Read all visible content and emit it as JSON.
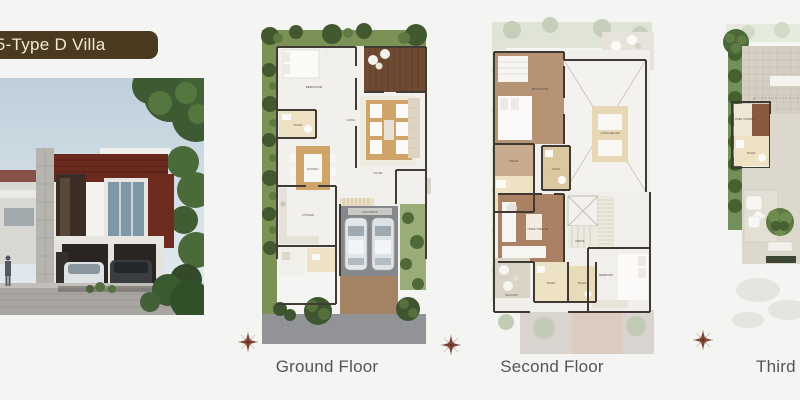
{
  "banner": {
    "label": "75-Type D Villa"
  },
  "floors": [
    {
      "label": "Ground Floor",
      "rooms": {
        "bedroom": "BEDROOM",
        "toilet": "TOILET",
        "dining": "DINING",
        "living": "LIVING",
        "kitchen": "KITCHEN",
        "foyer": "FOYER",
        "car_porch": "CAR PORCH",
        "deck": "DECK"
      }
    },
    {
      "label": "Second Floor",
      "rooms": {
        "bedroom1": "BEDROOM",
        "deck": "DECK",
        "living_below": "LIVING BELOW",
        "dress1": "DRESS",
        "toilet1": "TOILET",
        "toilet2": "TOILET",
        "home_theatre": "HOME THEATRE",
        "dress2": "DRESS",
        "bedroom2": "BEDROOM",
        "toilet3": "TOILET",
        "toilet4": "TOILET",
        "balcony": "BALCONY"
      }
    },
    {
      "label": "Third Floor",
      "rooms": {
        "open_shower": "OPEN SHOWER",
        "toilet": "TOILET"
      }
    }
  ],
  "icons": {
    "compass": "compass-rose"
  },
  "colors": {
    "page_bg": "#f4f4f2",
    "banner_bg": "#4a3a1f",
    "banner_text": "#f2ebd6",
    "landscape_green": "#7c9155",
    "tree_dark": "#42592f",
    "deck_brown": "#6f4a33",
    "room_brown": "#b59476",
    "room_cream": "#ede2c4",
    "furniture_beige": "#cfa469",
    "wall_dark": "#403c35",
    "road_gray": "#919396",
    "compass_red": "#7d4033",
    "label_gray": "#54555a"
  }
}
